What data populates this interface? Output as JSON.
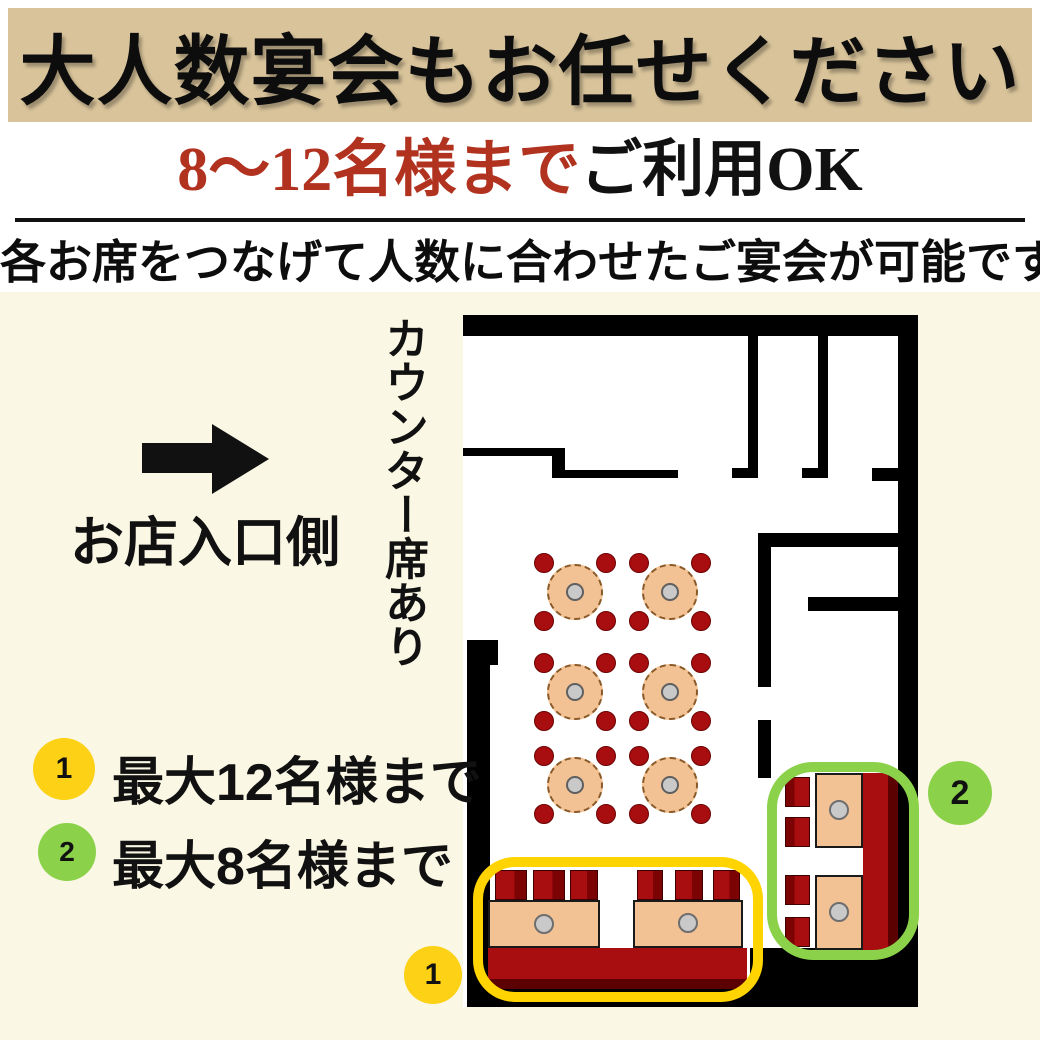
{
  "banner": {
    "title": "大人数宴会もお任せください",
    "bg_color": "#d8c39a"
  },
  "subtitle": {
    "highlight": "8〜12名様まで",
    "suffix": "ご利用OK",
    "highlight_color": "#b23220"
  },
  "description": "各お席をつなげて人数に合わせたご宴会が可能です",
  "entrance": {
    "arrow_icon": "right-arrow",
    "label": "お店入口側"
  },
  "counter_note": "カウンター席あり",
  "legend": {
    "items": [
      {
        "number": "1",
        "label": "最大12名様まで",
        "color": "#fcd116"
      },
      {
        "number": "2",
        "label": "最大8名様まで",
        "color": "#8bd24a"
      }
    ]
  },
  "floor_plan": {
    "round_tables": {
      "count": 6,
      "rows": 3,
      "cols": 2,
      "seats_per_table": 4
    },
    "areas": [
      {
        "number": "1",
        "capacity_label": "最大12名様まで",
        "outline_color": "#ffd400",
        "booth_tables": 2,
        "bench_seats": 6
      },
      {
        "number": "2",
        "capacity_label": "最大8名様まで",
        "outline_color": "#8bd24a",
        "booth_tables": 2,
        "bench_seats": 4
      }
    ],
    "colors": {
      "wall": "#000000",
      "floor": "#ffffff",
      "table": "#f3c294",
      "table_center": "#c9c9c9",
      "seat": "#a80d10",
      "seat_shade": "#7c0303",
      "page_background": "#faf7e4",
      "accent_red": "#b23220"
    }
  }
}
